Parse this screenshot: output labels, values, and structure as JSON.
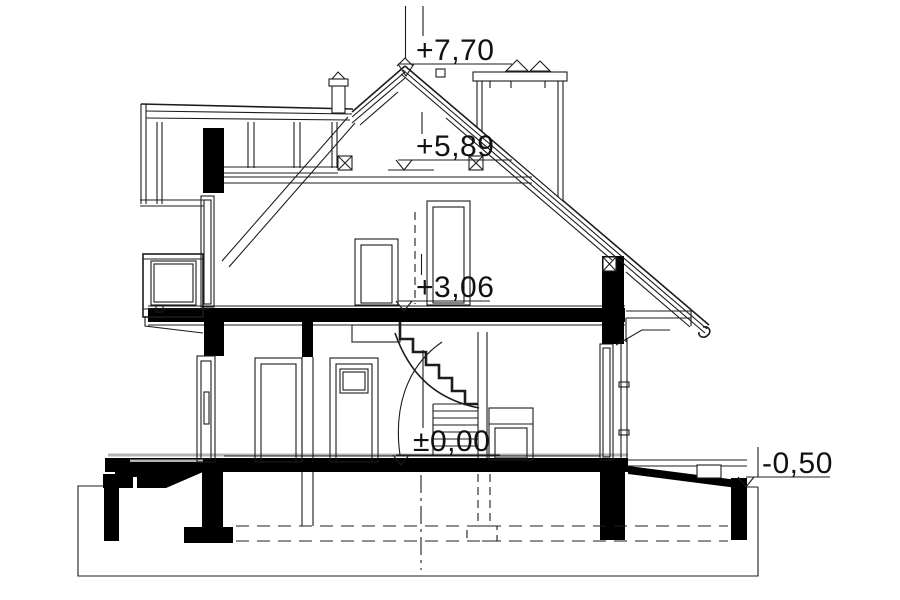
{
  "levels": {
    "ridge": {
      "label": "+7,70"
    },
    "attic": {
      "label": "+5,89"
    },
    "floor1": {
      "label": "+3,06"
    },
    "ground": {
      "label": "±0,00"
    },
    "terrain": {
      "label": "-0,50"
    }
  },
  "colors": {
    "line": "#1c1c1c",
    "fill": "#000000",
    "background": "#ffffff",
    "muted": "#b5b5b5"
  }
}
